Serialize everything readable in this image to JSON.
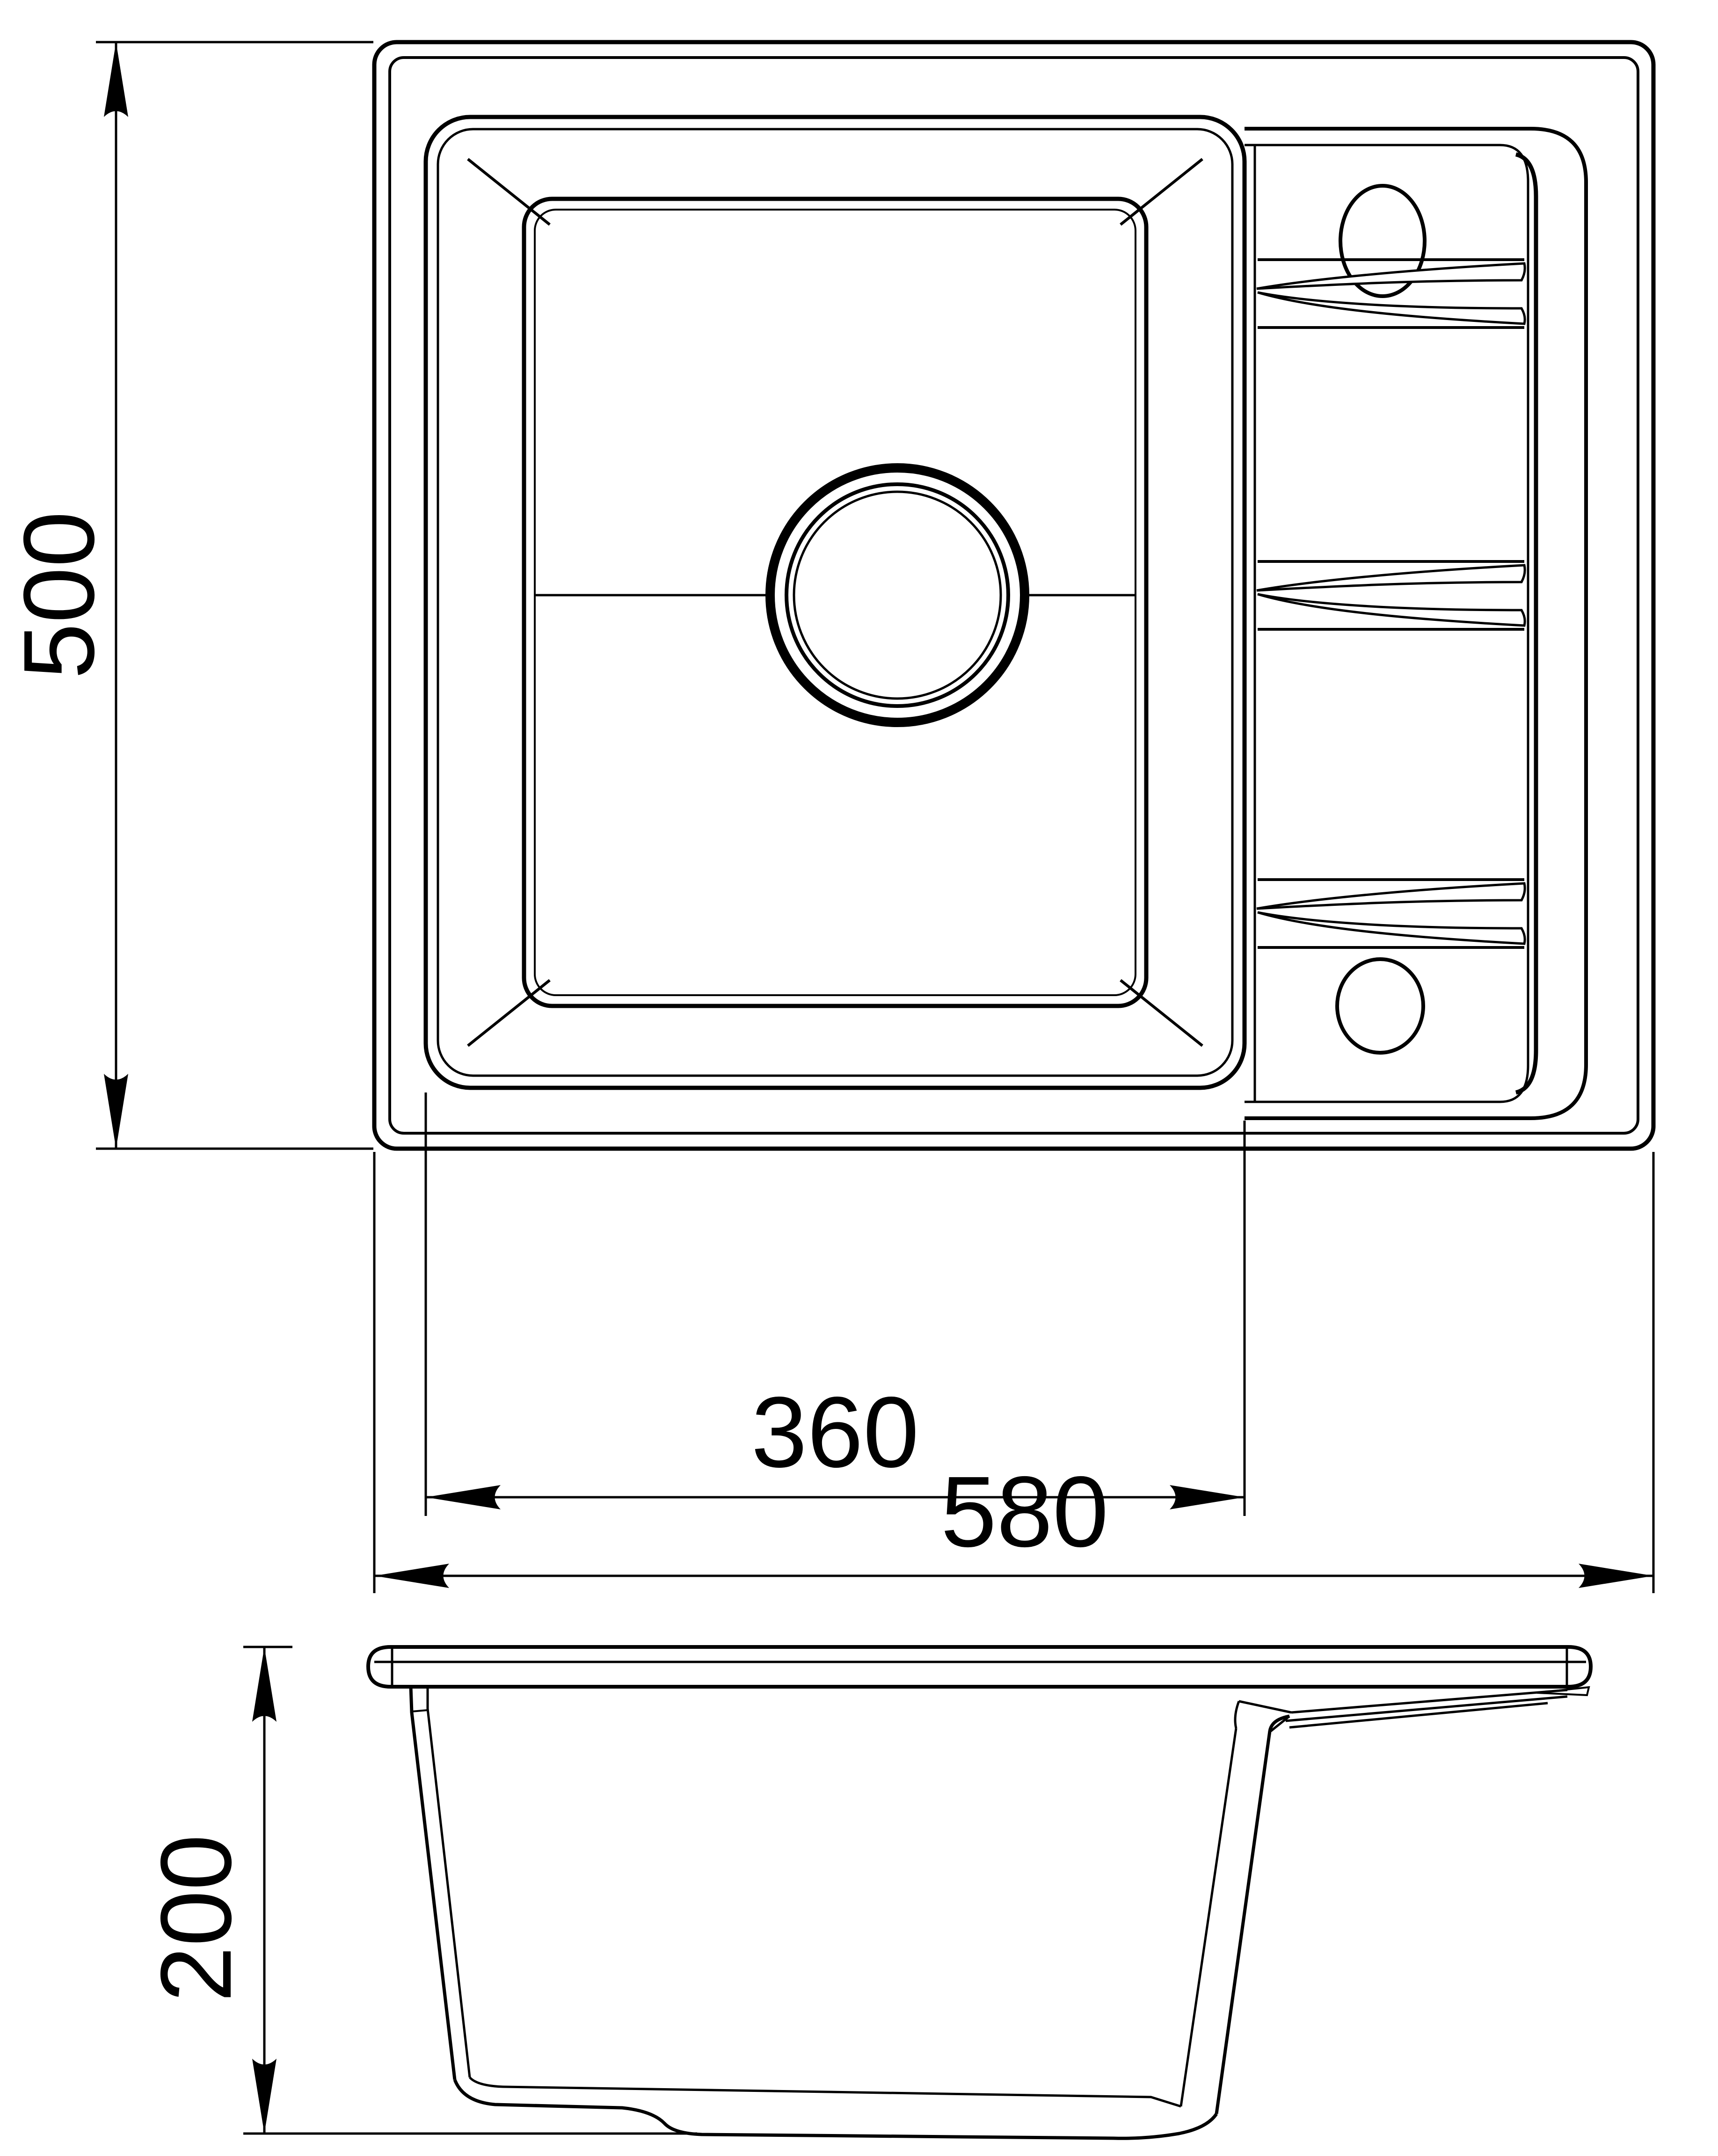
{
  "page": {
    "background": "#ffffff",
    "line_color": "#000000"
  },
  "dimensions": {
    "overall_depth": "500",
    "bowl_width": "360",
    "overall_width": "580",
    "bowl_height": "200"
  }
}
